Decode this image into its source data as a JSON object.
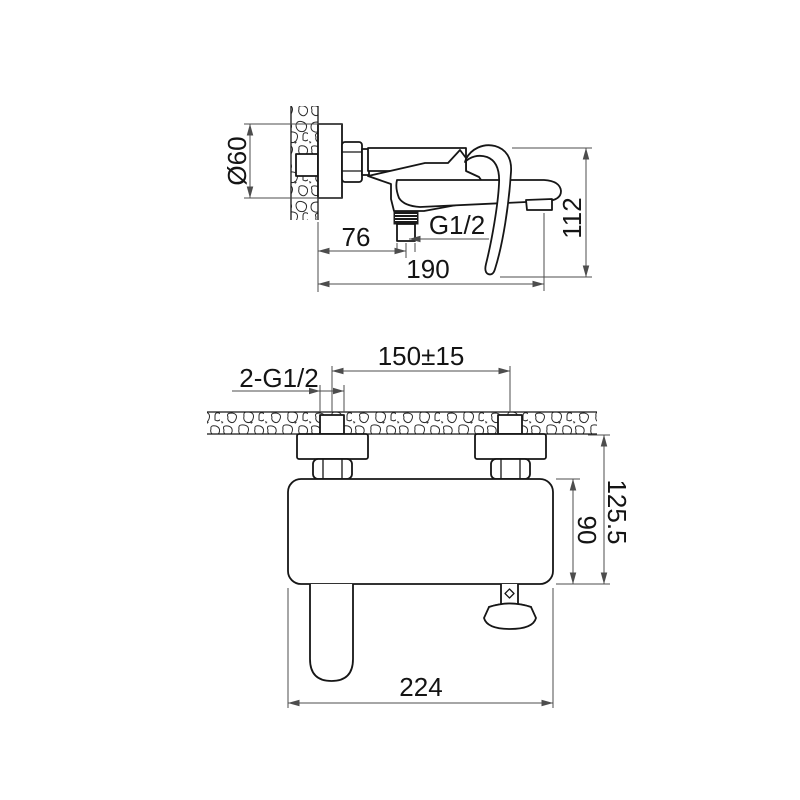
{
  "drawing": {
    "kind": "technical-dimension-drawing",
    "colors": {
      "background": "#ffffff",
      "object_line": "#161616",
      "dimension_line": "#4d4d4d",
      "text": "#141414"
    }
  },
  "side_view": {
    "dims": {
      "escutcheon_diameter": "Ø60",
      "wall_to_outlet": "76",
      "outlet_thread": "G1/2",
      "wall_to_spout_tip": "190",
      "overall_height": "112"
    }
  },
  "front_view": {
    "dims": {
      "inlet_thread": "2-G1/2",
      "inlet_spacing": "150±15",
      "body_height": "90",
      "height_below_wall": "125.5",
      "overall_width": "224"
    }
  }
}
